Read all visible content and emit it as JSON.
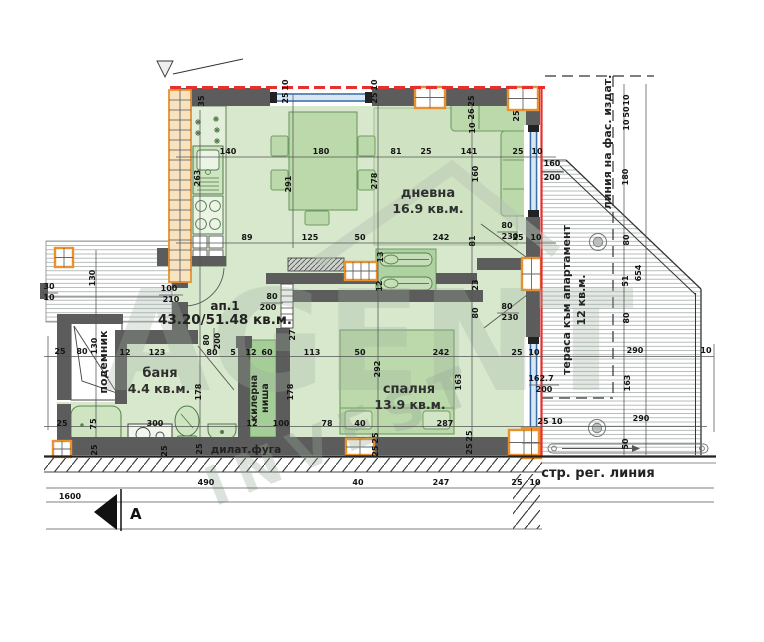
{
  "rooms": {
    "apartment": {
      "id": "ап.1",
      "area": "43.20/51.48 кв.м."
    },
    "living": {
      "name": "дневна",
      "area": "16.9 кв.м."
    },
    "bedroom": {
      "name": "спалня",
      "area": "13.9 кв.м."
    },
    "bathroom": {
      "name": "баня",
      "area": "4.4 кв.м."
    },
    "pantry": {
      "line1": "килерна",
      "line2": "ниша"
    },
    "lift": {
      "name": "подемник"
    },
    "terrace": {
      "name": "тераса към апартамент",
      "area": "12 кв.м."
    }
  },
  "annotations": {
    "facade_line": "линия на фас. издат.",
    "regulation_line": "стр. рег. линия",
    "dilatation_joint": "дилат.фуга",
    "section_letter": "А"
  },
  "watermark": {
    "line1": "AGENT",
    "line2": "INVEST"
  },
  "colors": {
    "wall": "#5c5c5c",
    "floor": "#d8e8cd",
    "furniture": "#bcd9ab",
    "accent_orange": "#e7912f",
    "facade_red": "#e53030",
    "glazing_blue": "#3a6ea5"
  },
  "dim_labels": [
    {
      "x": 204,
      "y": 101,
      "r": -90,
      "t": "35"
    },
    {
      "x": 288,
      "y": 98,
      "r": -90,
      "t": "25"
    },
    {
      "x": 288,
      "y": 85,
      "r": -90,
      "t": "10"
    },
    {
      "x": 377,
      "y": 98,
      "r": -90,
      "t": "25"
    },
    {
      "x": 377,
      "y": 85,
      "r": -90,
      "t": "10"
    },
    {
      "x": 474,
      "y": 101,
      "r": -90,
      "t": "25"
    },
    {
      "x": 474,
      "y": 114,
      "r": -90,
      "t": "26"
    },
    {
      "x": 475,
      "y": 128,
      "r": -90,
      "t": "10"
    },
    {
      "x": 519,
      "y": 116,
      "r": -90,
      "t": "25"
    },
    {
      "x": 228,
      "y": 154,
      "t": "140"
    },
    {
      "x": 321,
      "y": 154,
      "t": "180"
    },
    {
      "x": 396,
      "y": 154,
      "t": "81"
    },
    {
      "x": 426,
      "y": 154,
      "t": "25"
    },
    {
      "x": 469,
      "y": 154,
      "t": "141"
    },
    {
      "x": 518,
      "y": 154,
      "t": "25"
    },
    {
      "x": 537,
      "y": 154,
      "t": "10"
    },
    {
      "x": 552,
      "y": 166,
      "t": "160"
    },
    {
      "x": 552,
      "y": 180,
      "t": "200"
    },
    {
      "x": 200,
      "y": 178,
      "r": -90,
      "t": "263"
    },
    {
      "x": 291,
      "y": 184,
      "r": -90,
      "t": "291"
    },
    {
      "x": 377,
      "y": 181,
      "r": -90,
      "t": "278"
    },
    {
      "x": 478,
      "y": 174,
      "r": -90,
      "t": "160"
    },
    {
      "x": 247,
      "y": 240,
      "t": "89"
    },
    {
      "x": 310,
      "y": 240,
      "t": "125"
    },
    {
      "x": 360,
      "y": 240,
      "t": "50"
    },
    {
      "x": 441,
      "y": 240,
      "t": "242"
    },
    {
      "x": 475,
      "y": 241,
      "r": -90,
      "t": "81"
    },
    {
      "x": 518,
      "y": 240,
      "t": "25"
    },
    {
      "x": 536,
      "y": 240,
      "t": "10"
    },
    {
      "x": 507,
      "y": 228,
      "t": "80"
    },
    {
      "x": 510,
      "y": 239,
      "t": "230"
    },
    {
      "x": 169,
      "y": 291,
      "t": "100"
    },
    {
      "x": 171,
      "y": 302,
      "t": "210"
    },
    {
      "x": 272,
      "y": 299,
      "t": "80"
    },
    {
      "x": 268,
      "y": 310,
      "t": "200"
    },
    {
      "x": 209,
      "y": 340,
      "r": -90,
      "t": "80"
    },
    {
      "x": 220,
      "y": 341,
      "r": -90,
      "t": "200"
    },
    {
      "x": 295,
      "y": 335,
      "r": -90,
      "t": "27"
    },
    {
      "x": 383,
      "y": 257,
      "r": -90,
      "t": "13"
    },
    {
      "x": 382,
      "y": 286,
      "r": -90,
      "t": "12"
    },
    {
      "x": 478,
      "y": 285,
      "r": -90,
      "t": "23"
    },
    {
      "x": 478,
      "y": 313,
      "r": -90,
      "t": "80"
    },
    {
      "x": 507,
      "y": 309,
      "t": "80"
    },
    {
      "x": 510,
      "y": 320,
      "t": "230"
    },
    {
      "x": 60,
      "y": 354,
      "t": "25"
    },
    {
      "x": 82,
      "y": 354,
      "t": "80"
    },
    {
      "x": 95,
      "y": 278,
      "r": -90,
      "t": "130"
    },
    {
      "x": 97,
      "y": 346,
      "r": -90,
      "t": "130"
    },
    {
      "x": 49,
      "y": 289,
      "t": "30"
    },
    {
      "x": 49,
      "y": 300,
      "t": "10"
    },
    {
      "x": 125,
      "y": 355,
      "t": "12"
    },
    {
      "x": 157,
      "y": 355,
      "t": "123"
    },
    {
      "x": 212,
      "y": 355,
      "t": "80"
    },
    {
      "x": 233,
      "y": 355,
      "t": "5"
    },
    {
      "x": 251,
      "y": 355,
      "t": "12"
    },
    {
      "x": 267,
      "y": 355,
      "t": "60"
    },
    {
      "x": 312,
      "y": 355,
      "t": "113"
    },
    {
      "x": 360,
      "y": 355,
      "t": "50"
    },
    {
      "x": 441,
      "y": 355,
      "t": "242"
    },
    {
      "x": 517,
      "y": 355,
      "t": "25"
    },
    {
      "x": 534,
      "y": 355,
      "t": "10"
    },
    {
      "x": 201,
      "y": 392,
      "r": -90,
      "t": "178"
    },
    {
      "x": 293,
      "y": 392,
      "r": -90,
      "t": "178"
    },
    {
      "x": 380,
      "y": 369,
      "r": -90,
      "t": "292"
    },
    {
      "x": 461,
      "y": 382,
      "r": -90,
      "t": "163"
    },
    {
      "x": 62,
      "y": 426,
      "t": "25"
    },
    {
      "x": 96,
      "y": 424,
      "r": -90,
      "t": "75"
    },
    {
      "x": 155,
      "y": 426,
      "t": "300"
    },
    {
      "x": 252,
      "y": 426,
      "t": "12"
    },
    {
      "x": 281,
      "y": 426,
      "t": "100"
    },
    {
      "x": 327,
      "y": 426,
      "t": "78"
    },
    {
      "x": 360,
      "y": 426,
      "t": "40"
    },
    {
      "x": 445,
      "y": 426,
      "t": "287"
    },
    {
      "x": 97,
      "y": 450,
      "r": -90,
      "t": "25"
    },
    {
      "x": 167,
      "y": 451,
      "r": -90,
      "t": "25"
    },
    {
      "x": 202,
      "y": 449,
      "r": -90,
      "t": "25"
    },
    {
      "x": 378,
      "y": 438,
      "r": -90,
      "t": "25"
    },
    {
      "x": 378,
      "y": 451,
      "r": -90,
      "t": "25"
    },
    {
      "x": 472,
      "y": 436,
      "r": -90,
      "t": "25"
    },
    {
      "x": 472,
      "y": 449,
      "r": -90,
      "t": "25"
    },
    {
      "x": 541,
      "y": 381,
      "t": "162.7"
    },
    {
      "x": 544,
      "y": 392,
      "t": "200"
    },
    {
      "x": 543,
      "y": 424,
      "t": "25"
    },
    {
      "x": 557,
      "y": 424,
      "t": "10"
    },
    {
      "x": 629,
      "y": 100,
      "r": -90,
      "t": "10"
    },
    {
      "x": 629,
      "y": 112,
      "r": -90,
      "t": "50"
    },
    {
      "x": 629,
      "y": 125,
      "r": -90,
      "t": "10"
    },
    {
      "x": 628,
      "y": 177,
      "r": -90,
      "t": "180"
    },
    {
      "x": 629,
      "y": 240,
      "r": -90,
      "t": "80"
    },
    {
      "x": 641,
      "y": 273,
      "r": -90,
      "t": "654"
    },
    {
      "x": 628,
      "y": 281,
      "r": -90,
      "t": "51"
    },
    {
      "x": 629,
      "y": 318,
      "r": -90,
      "t": "80"
    },
    {
      "x": 635,
      "y": 353,
      "t": "290"
    },
    {
      "x": 630,
      "y": 383,
      "r": -90,
      "t": "163"
    },
    {
      "x": 641,
      "y": 421,
      "t": "290"
    },
    {
      "x": 628,
      "y": 444,
      "r": -90,
      "t": "50"
    },
    {
      "x": 706,
      "y": 353,
      "t": "10"
    },
    {
      "x": 206,
      "y": 485,
      "t": "490"
    },
    {
      "x": 70,
      "y": 499,
      "t": "1600"
    },
    {
      "x": 358,
      "y": 485,
      "t": "40"
    },
    {
      "x": 441,
      "y": 485,
      "t": "247"
    },
    {
      "x": 517,
      "y": 485,
      "t": "25"
    },
    {
      "x": 535,
      "y": 485,
      "t": "10"
    }
  ]
}
